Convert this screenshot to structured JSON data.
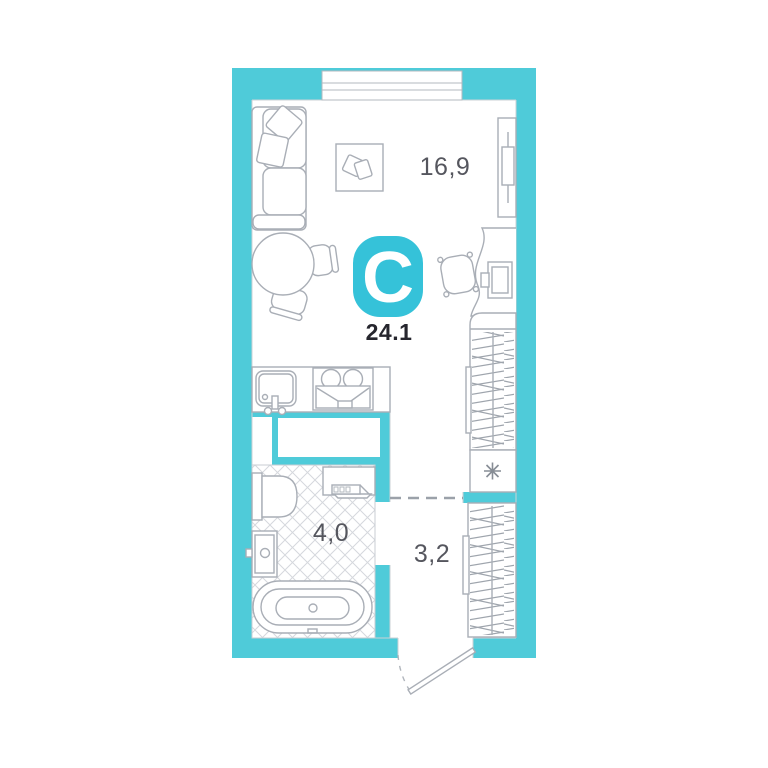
{
  "logo": {
    "letter": "C"
  },
  "total_area": "24.1",
  "rooms": {
    "living_room": {
      "area": "16,9"
    },
    "bathroom": {
      "area": "4,0"
    },
    "hallway": {
      "area": "3,2"
    }
  },
  "colors": {
    "wall": "#4FCBD9",
    "accent": "#35C2D9",
    "total_area_text": "#26262E",
    "area_label_text": "#55565E",
    "furniture_outline": "#A9AEB6"
  },
  "icons": {
    "fridge_marker": "✳",
    "door_swing": "dashed-arc",
    "wardrobe_fill": "hanger-hatch",
    "bathroom_floor": "diagonal-tile-hatch"
  }
}
